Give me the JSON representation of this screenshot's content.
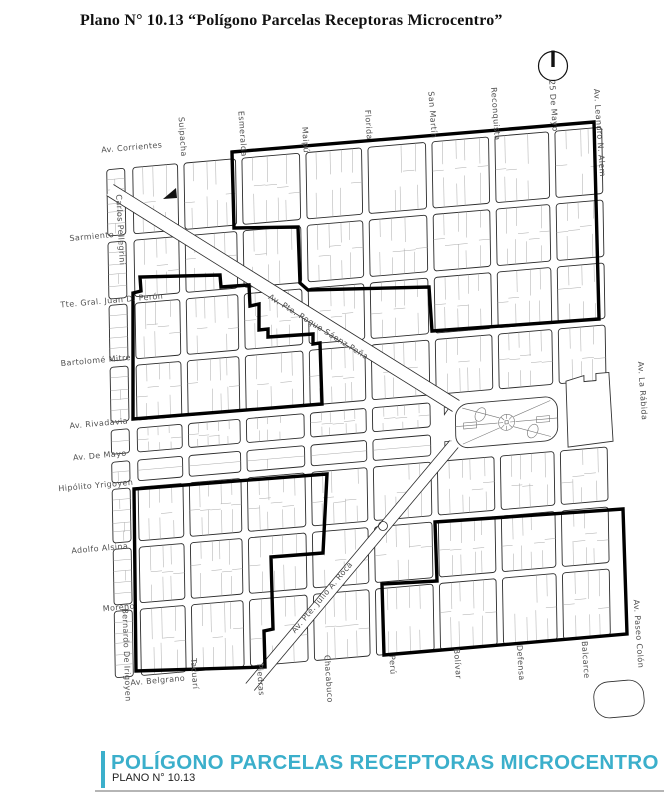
{
  "title": "Plano N° 10.13 “Polígono Parcelas Receptoras Microcentro”",
  "footer": {
    "title": "POLÍGONO PARCELAS RECEPTORAS MICROCENTRO",
    "subtitle": "PLANO N° 10.13",
    "accent_color": "#3BAFCB"
  },
  "map": {
    "grid": {
      "cols": [
        108,
        133,
        185,
        243,
        307,
        369,
        433,
        496,
        556,
        610
      ],
      "col_gaps": [
        3,
        4,
        3.2,
        3.2,
        3.2,
        3.2,
        3.2,
        3.2,
        3.2,
        4
      ],
      "rows": [
        143,
        217,
        280,
        342,
        404,
        436,
        464,
        524,
        586,
        660
      ],
      "row_gaps": [
        4.5,
        3.2,
        3.2,
        3.2,
        4,
        4,
        3.2,
        3.2,
        3.2,
        4.5
      ]
    },
    "diagonals": [
      {
        "name": "Av. Pte. Roque Sáenz Peña",
        "from": [
          110,
          190
        ],
        "to": [
          456,
          406
        ],
        "width": 13
      },
      {
        "name": "Av. Pte. Julio A. Roca",
        "from": [
          454,
          444
        ],
        "to": [
          250,
          687
        ],
        "width": 11
      }
    ],
    "polygons": [
      [
        [
          232,
          152
        ],
        [
          594,
          122
        ],
        [
          599,
          319
        ],
        [
          432,
          331
        ],
        [
          429,
          287
        ],
        [
          308,
          290
        ],
        [
          300,
          283
        ],
        [
          298,
          227
        ],
        [
          234,
          228
        ]
      ],
      [
        [
          133,
          293
        ],
        [
          141,
          291
        ],
        [
          140,
          277
        ],
        [
          220,
          275
        ],
        [
          221,
          287
        ],
        [
          249,
          285
        ],
        [
          250,
          306
        ],
        [
          259,
          304
        ],
        [
          259,
          330
        ],
        [
          268,
          329
        ],
        [
          268,
          337
        ],
        [
          313,
          334
        ],
        [
          313,
          344
        ],
        [
          320,
          343
        ],
        [
          322,
          404
        ],
        [
          133,
          419
        ]
      ],
      [
        [
          134,
          489
        ],
        [
          327,
          474
        ],
        [
          323,
          553
        ],
        [
          271,
          557
        ],
        [
          273,
          629
        ],
        [
          264,
          631
        ],
        [
          265,
          667
        ],
        [
          136,
          671
        ]
      ],
      [
        [
          435,
          522
        ],
        [
          623,
          509
        ],
        [
          627,
          634
        ],
        [
          430,
          651
        ],
        [
          384,
          655
        ],
        [
          382,
          584
        ],
        [
          437,
          581
        ]
      ]
    ],
    "plaza": {
      "name": "Plaza de Mayo",
      "x": 455,
      "y": 412,
      "w": 102,
      "h": 44
    },
    "government_block": {
      "path": "M566,398 L584,394 L584,400 L596,400 L596,393 L609,393 L612,462 L567,464 Z"
    },
    "park_blob": {
      "x": 594,
      "y": 681,
      "w": 50,
      "h": 36
    },
    "roundabout": {
      "cx": 383,
      "cy": 526,
      "r": 4.5
    },
    "obelisk": [
      [
        163,
        199
      ],
      [
        176,
        188
      ],
      [
        177,
        198
      ]
    ],
    "compass": {
      "cx": 553,
      "cy": 66,
      "r": 14.5
    },
    "labels": [
      {
        "text": "Av. Corrientes",
        "x": 132,
        "y": 150,
        "rot": -5
      },
      {
        "text": "Carlos Pellegrini",
        "x": 118,
        "y": 230,
        "rot": 87
      },
      {
        "text": "Sarmiento",
        "x": 92,
        "y": 239,
        "rot": -5
      },
      {
        "text": "Tte. Gral. Juan D. Perón",
        "x": 112,
        "y": 303,
        "rot": -5
      },
      {
        "text": "Bartolomé Mitre",
        "x": 96,
        "y": 363,
        "rot": -5
      },
      {
        "text": "Av. Rivadavia",
        "x": 99,
        "y": 426,
        "rot": -5
      },
      {
        "text": "Av. De Mayo",
        "x": 100,
        "y": 458,
        "rot": -5
      },
      {
        "text": "Hipólito Yrigoyen",
        "x": 96,
        "y": 488,
        "rot": -5
      },
      {
        "text": "Adolfo Alsina",
        "x": 100,
        "y": 551,
        "rot": -5
      },
      {
        "text": "Moreno",
        "x": 119,
        "y": 610,
        "rot": -5
      },
      {
        "text": "Bernardo De Irigoyen",
        "x": 124,
        "y": 655,
        "rot": 88
      },
      {
        "text": "Av. Belgrano",
        "x": 158,
        "y": 683,
        "rot": -5
      },
      {
        "text": "Suipacha",
        "x": 180,
        "y": 137,
        "rot": 86
      },
      {
        "text": "Esmeralda",
        "x": 240,
        "y": 134,
        "rot": 86
      },
      {
        "text": "Maipú",
        "x": 303,
        "y": 140,
        "rot": 86
      },
      {
        "text": "Florida",
        "x": 366,
        "y": 125,
        "rot": 86
      },
      {
        "text": "San Martín",
        "x": 430,
        "y": 115,
        "rot": 86
      },
      {
        "text": "Reconquista",
        "x": 493,
        "y": 114,
        "rot": 86
      },
      {
        "text": "25 De Mayo",
        "x": 551,
        "y": 106,
        "rot": 86
      },
      {
        "text": "Av. Leandro N. Alem",
        "x": 597,
        "y": 133,
        "rot": 86
      },
      {
        "text": "Av. La Rábida",
        "x": 640,
        "y": 391,
        "rot": 86
      },
      {
        "text": "Av. Paseo Colón",
        "x": 636,
        "y": 634,
        "rot": 86
      },
      {
        "text": "Tacuarí",
        "x": 192,
        "y": 674,
        "rot": 86
      },
      {
        "text": "Piedras",
        "x": 258,
        "y": 680,
        "rot": 86
      },
      {
        "text": "Chacabuco",
        "x": 326,
        "y": 679,
        "rot": 86
      },
      {
        "text": "Perú",
        "x": 390,
        "y": 665,
        "rot": 86
      },
      {
        "text": "Bolívar",
        "x": 455,
        "y": 664,
        "rot": 86
      },
      {
        "text": "Defensa",
        "x": 518,
        "y": 663,
        "rot": 86
      },
      {
        "text": "Balcarce",
        "x": 583,
        "y": 660,
        "rot": 86
      },
      {
        "text": "Av. Pte. Roque Sáenz Peña",
        "x": 317,
        "y": 329,
        "rot": 32,
        "spacing": 1.5
      },
      {
        "text": "Av. Pte. Julio A. Roca",
        "x": 324,
        "y": 599,
        "rot": -50,
        "spacing": 1
      }
    ]
  }
}
